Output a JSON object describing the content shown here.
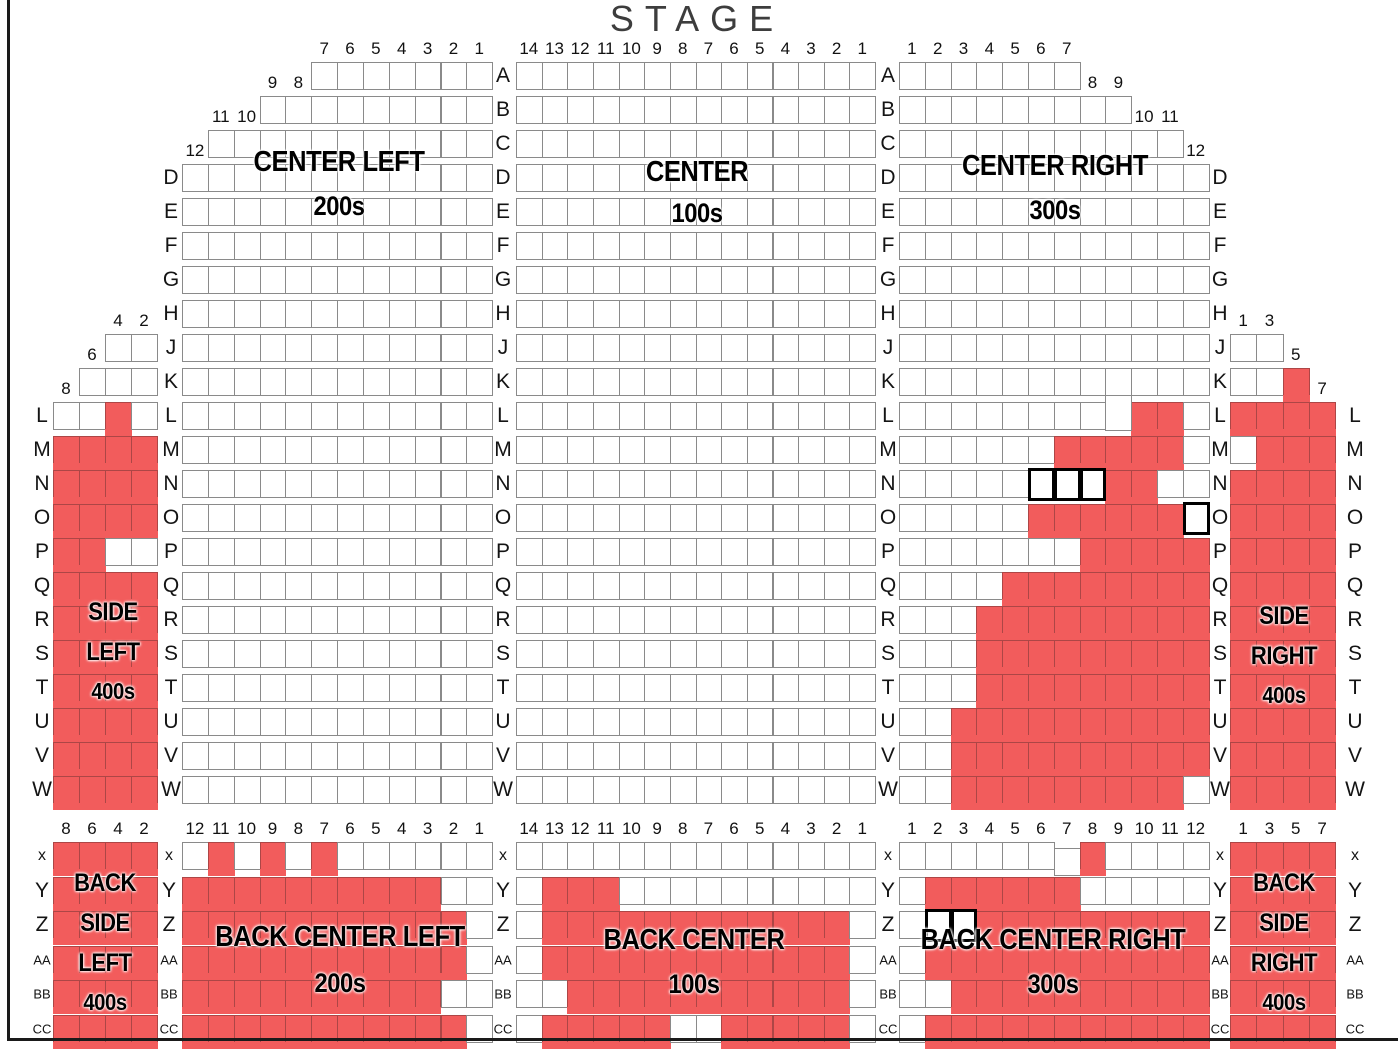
{
  "stage_label": "STAGE",
  "colors": {
    "available": "#ffffff",
    "sold": "#f25c5c",
    "seat_border": "#8a8a8a",
    "highlight_border": "#000000"
  },
  "sections": [
    {
      "id": "side_left",
      "name": "Side Left",
      "label_lines": [
        "SIDE",
        "LEFT",
        "400s"
      ],
      "headers": [
        {
          "above": "J",
          "start": 2,
          "nums": [
            "4",
            "2"
          ]
        },
        {
          "above": "K",
          "start": 1,
          "nums": [
            "6"
          ]
        },
        {
          "above": "L",
          "start": 0,
          "nums": [
            "8"
          ]
        }
      ],
      "rows": [
        {
          "r": "J",
          "off": 2,
          "s": "oo"
        },
        {
          "r": "K",
          "off": 1,
          "s": "ooo"
        },
        {
          "r": "L",
          "s": "ooxo"
        },
        {
          "r": "M",
          "s": "xxxx"
        },
        {
          "r": "N",
          "s": "xxxx"
        },
        {
          "r": "O",
          "s": "xxxx"
        },
        {
          "r": "P",
          "s": "xxoo"
        },
        {
          "r": "Q",
          "s": "xxxx"
        },
        {
          "r": "R",
          "s": "xxxx"
        },
        {
          "r": "S",
          "s": "xxxx"
        },
        {
          "r": "T",
          "s": "xxxx"
        },
        {
          "r": "U",
          "s": "xxxx"
        },
        {
          "r": "V",
          "s": "xxxx"
        },
        {
          "r": "W",
          "s": "xxxx"
        }
      ]
    },
    {
      "id": "center_left",
      "name": "Center Left",
      "label_lines": [
        "CENTER LEFT",
        "200s"
      ],
      "headers": [
        {
          "above": "A",
          "start": 5,
          "nums": [
            "7",
            "6",
            "5",
            "4",
            "3",
            "2",
            "1"
          ]
        },
        {
          "above": "B",
          "start": 3,
          "nums": [
            "9",
            "8"
          ]
        },
        {
          "above": "C",
          "start": 1,
          "nums": [
            "11",
            "10"
          ]
        },
        {
          "above": "D",
          "start": 0,
          "nums": [
            "12"
          ]
        }
      ],
      "rows": [
        {
          "r": "A",
          "off": 5,
          "s": "ooooooo"
        },
        {
          "r": "B",
          "off": 3,
          "s": "ooooooooo"
        },
        {
          "r": "C",
          "off": 1,
          "s": "ooooooooooo"
        },
        {
          "r": "D",
          "s": "oooooooooooo"
        },
        {
          "r": "E",
          "s": "oooooooooooo"
        },
        {
          "r": "F",
          "s": "oooooooooooo"
        },
        {
          "r": "G",
          "s": "oooooooooooo"
        },
        {
          "r": "H",
          "s": "oooooooooooo"
        },
        {
          "r": "J",
          "s": "oooooooooooo"
        },
        {
          "r": "K",
          "s": "oooooooooooo"
        },
        {
          "r": "L",
          "s": "oooooooooooo"
        },
        {
          "r": "M",
          "s": "oooooooooooo"
        },
        {
          "r": "N",
          "s": "oooooooooooo"
        },
        {
          "r": "O",
          "s": "oooooooooooo"
        },
        {
          "r": "P",
          "s": "oooooooooooo"
        },
        {
          "r": "Q",
          "s": "oooooooooooo"
        },
        {
          "r": "R",
          "s": "oooooooooooo"
        },
        {
          "r": "S",
          "s": "oooooooooooo"
        },
        {
          "r": "T",
          "s": "oooooooooooo"
        },
        {
          "r": "U",
          "s": "oooooooooooo"
        },
        {
          "r": "V",
          "s": "oooooooooooo"
        },
        {
          "r": "W",
          "s": "oooooooooooo"
        }
      ]
    },
    {
      "id": "center",
      "name": "Center",
      "label_lines": [
        "CENTER",
        "100s"
      ],
      "headers": [
        {
          "above": "A",
          "start": 0,
          "nums": [
            "14",
            "13",
            "12",
            "11",
            "10",
            "9",
            "8",
            "7",
            "6",
            "5",
            "4",
            "3",
            "2",
            "1"
          ]
        }
      ],
      "rows": [
        {
          "r": "A",
          "s": "oooooooooooooo"
        },
        {
          "r": "B",
          "s": "oooooooooooooo"
        },
        {
          "r": "C",
          "s": "oooooooooooooo"
        },
        {
          "r": "D",
          "s": "oooooooooooooo"
        },
        {
          "r": "E",
          "s": "oooooooooooooo"
        },
        {
          "r": "F",
          "s": "oooooooooooooo"
        },
        {
          "r": "G",
          "s": "oooooooooooooo"
        },
        {
          "r": "H",
          "s": "oooooooooooooo"
        },
        {
          "r": "J",
          "s": "oooooooooooooo"
        },
        {
          "r": "K",
          "s": "oooooooooooooo"
        },
        {
          "r": "L",
          "s": "oooooooooooooo"
        },
        {
          "r": "M",
          "s": "oooooooooooooo"
        },
        {
          "r": "N",
          "s": "oooooooooooooo"
        },
        {
          "r": "O",
          "s": "oooooooooooooo"
        },
        {
          "r": "P",
          "s": "oooooooooooooo"
        },
        {
          "r": "Q",
          "s": "oooooooooooooo"
        },
        {
          "r": "R",
          "s": "oooooooooooooo"
        },
        {
          "r": "S",
          "s": "oooooooooooooo"
        },
        {
          "r": "T",
          "s": "oooooooooooooo"
        },
        {
          "r": "U",
          "s": "oooooooooooooo"
        },
        {
          "r": "V",
          "s": "oooooooooooooo"
        },
        {
          "r": "W",
          "s": "oooooooooooooo"
        }
      ]
    },
    {
      "id": "center_right",
      "name": "Center Right",
      "label_lines": [
        "CENTER RIGHT",
        "300s"
      ],
      "headers": [
        {
          "above": "A",
          "start": 0,
          "nums": [
            "1",
            "2",
            "3",
            "4",
            "5",
            "6",
            "7"
          ]
        },
        {
          "above": "B",
          "start": 7,
          "nums": [
            "8",
            "9"
          ]
        },
        {
          "above": "C",
          "start": 9,
          "nums": [
            "10",
            "11"
          ]
        },
        {
          "above": "D",
          "start": 11,
          "nums": [
            "12"
          ]
        }
      ],
      "rows": [
        {
          "r": "A",
          "s": "ooooooo"
        },
        {
          "r": "B",
          "s": "ooooooooo"
        },
        {
          "r": "C",
          "s": "ooooooooooo"
        },
        {
          "r": "D",
          "s": "oooooooooooo"
        },
        {
          "r": "E",
          "s": "oooooooooooo"
        },
        {
          "r": "F",
          "s": "oooooooooooo"
        },
        {
          "r": "G",
          "s": "oooooooooooo"
        },
        {
          "r": "H",
          "s": "oooooooooooo"
        },
        {
          "r": "J",
          "s": "oooooooooooo"
        },
        {
          "r": "K",
          "s": "oooooooooooo"
        },
        {
          "r": "L",
          "s": "oooooooooxxo",
          "raised": [
            8
          ]
        },
        {
          "r": "M",
          "s": "ooooooxxxxxo"
        },
        {
          "r": "N",
          "s": "ooooohhhxxoo"
        },
        {
          "r": "O",
          "s": "oooooxxxxxxh"
        },
        {
          "r": "P",
          "s": "oooooooxxxxx"
        },
        {
          "r": "Q",
          "s": "ooooxxxxxxxx"
        },
        {
          "r": "R",
          "s": "oooxxxxxxxxx"
        },
        {
          "r": "S",
          "s": "oooxxxxxxxxx"
        },
        {
          "r": "T",
          "s": "oooxxxxxxxxx"
        },
        {
          "r": "U",
          "s": "ooxxxxxxxxxx"
        },
        {
          "r": "V",
          "s": "ooxxxxxxxxxx"
        },
        {
          "r": "W",
          "s": "ooxxxxxxxxxo"
        }
      ]
    },
    {
      "id": "side_right",
      "name": "Side Right",
      "label_lines": [
        "SIDE",
        "RIGHT",
        "400s"
      ],
      "headers": [
        {
          "above": "J",
          "start": 0,
          "nums": [
            "1",
            "3"
          ]
        },
        {
          "above": "K",
          "start": 2,
          "nums": [
            "5"
          ]
        },
        {
          "above": "L",
          "start": 3,
          "nums": [
            "7"
          ]
        }
      ],
      "rows": [
        {
          "r": "J",
          "s": "oo"
        },
        {
          "r": "K",
          "s": "oox"
        },
        {
          "r": "L",
          "s": "xxxx"
        },
        {
          "r": "M",
          "s": "oxxx"
        },
        {
          "r": "N",
          "s": "xxxx"
        },
        {
          "r": "O",
          "s": "xxxx"
        },
        {
          "r": "P",
          "s": "xxxx"
        },
        {
          "r": "Q",
          "s": "xxxx"
        },
        {
          "r": "R",
          "s": "xxxx"
        },
        {
          "r": "S",
          "s": "xxxx"
        },
        {
          "r": "T",
          "s": "xxxx"
        },
        {
          "r": "U",
          "s": "xxxx"
        },
        {
          "r": "V",
          "s": "xxxx"
        },
        {
          "r": "W",
          "s": "xxxx"
        }
      ]
    },
    {
      "id": "back_side_left",
      "name": "Back Side Left",
      "label_lines": [
        "BACK",
        "SIDE",
        "LEFT",
        "400s"
      ],
      "headers": [
        {
          "above": "x",
          "start": 0,
          "nums": [
            "8",
            "6",
            "4",
            "2"
          ]
        }
      ],
      "rows": [
        {
          "r": "x",
          "s": "xxxx"
        },
        {
          "r": "Y",
          "s": "xxxx"
        },
        {
          "r": "Z",
          "s": "xxxx"
        },
        {
          "r": "AA",
          "s": "xxxx"
        },
        {
          "r": "BB",
          "s": "xxxx"
        },
        {
          "r": "CC",
          "s": "xxxx"
        }
      ]
    },
    {
      "id": "back_center_left",
      "name": "Back Center Left",
      "label_lines": [
        "BACK CENTER LEFT",
        "200s"
      ],
      "headers": [
        {
          "above": "x",
          "start": 0,
          "nums": [
            "12",
            "11",
            "10",
            "9",
            "8",
            "7",
            "6",
            "5",
            "4",
            "3",
            "2",
            "1"
          ]
        }
      ],
      "rows": [
        {
          "r": "x",
          "s": "oxoxoxoooooo"
        },
        {
          "r": "Y",
          "s": "xxxxxxxxxxoo"
        },
        {
          "r": "Z",
          "s": "xxxxxxxxxxxo"
        },
        {
          "r": "AA",
          "s": "xxxxxxxxxxxo"
        },
        {
          "r": "BB",
          "s": "xxxxxxxxxxoo"
        },
        {
          "r": "CC",
          "s": "xxxxxxxxxxxo"
        }
      ]
    },
    {
      "id": "back_center",
      "name": "Back Center",
      "label_lines": [
        "BACK CENTER",
        "100s"
      ],
      "headers": [
        {
          "above": "x",
          "start": 0,
          "nums": [
            "14",
            "13",
            "12",
            "11",
            "10",
            "9",
            "8",
            "7",
            "6",
            "5",
            "4",
            "3",
            "2",
            "1"
          ]
        }
      ],
      "rows": [
        {
          "r": "x",
          "s": "oooooooooooooo"
        },
        {
          "r": "Y",
          "s": "oxxxoooooooooo"
        },
        {
          "r": "Z",
          "s": "oxxxxxxxxxxxxo"
        },
        {
          "r": "AA",
          "s": "oxxxxxxxxxxxxo"
        },
        {
          "r": "BB",
          "s": "ooxxxxxxxxxxxo"
        },
        {
          "r": "CC",
          "s": "oxxxxxooxxxxxo"
        }
      ]
    },
    {
      "id": "back_center_right",
      "name": "Back Center Right",
      "label_lines": [
        "BACK CENTER RIGHT",
        "300s"
      ],
      "headers": [
        {
          "above": "x",
          "start": 0,
          "nums": [
            "1",
            "2",
            "3",
            "4",
            "5",
            "6",
            "7",
            "8",
            "9",
            "10",
            "11",
            "12"
          ]
        }
      ],
      "rows": [
        {
          "r": "x",
          "s": "oooooooxoooo",
          "dropped": [
            6
          ]
        },
        {
          "r": "Y",
          "s": "oxxxxxxooooo"
        },
        {
          "r": "Z",
          "s": "ohhxxxxxxxxx"
        },
        {
          "r": "AA",
          "s": "oxxxxxxxxxxx"
        },
        {
          "r": "BB",
          "s": "ooxxxxxxxxxx"
        },
        {
          "r": "CC",
          "s": "oxxxxxxxxxxx"
        }
      ]
    },
    {
      "id": "back_side_right",
      "name": "Back Side Right",
      "label_lines": [
        "BACK",
        "SIDE",
        "RIGHT",
        "400s"
      ],
      "headers": [
        {
          "above": "x",
          "start": 0,
          "nums": [
            "1",
            "3",
            "5",
            "7"
          ]
        }
      ],
      "rows": [
        {
          "r": "x",
          "s": "xxxx"
        },
        {
          "r": "Y",
          "s": "xxxx"
        },
        {
          "r": "Z",
          "s": "xxxx"
        },
        {
          "r": "AA",
          "s": "xxxx"
        },
        {
          "r": "BB",
          "s": "xxxx"
        },
        {
          "r": "CC",
          "s": "xxxx"
        }
      ]
    }
  ],
  "row_label_columns": [
    {
      "id": "far-left-top",
      "letters": [
        "L",
        "M",
        "N",
        "O",
        "P",
        "Q",
        "R",
        "S",
        "T",
        "U",
        "V",
        "W"
      ]
    },
    {
      "id": "left-top",
      "letters": [
        "D",
        "E",
        "F",
        "G",
        "H",
        "J",
        "K",
        "L",
        "M",
        "N",
        "O",
        "P",
        "Q",
        "R",
        "S",
        "T",
        "U",
        "V",
        "W"
      ]
    },
    {
      "id": "center-left-top",
      "letters": [
        "A",
        "B",
        "C",
        "D",
        "E",
        "F",
        "G",
        "H",
        "J",
        "K",
        "L",
        "M",
        "N",
        "O",
        "P",
        "Q",
        "R",
        "S",
        "T",
        "U",
        "V",
        "W"
      ]
    },
    {
      "id": "center-right-top",
      "letters": [
        "A",
        "B",
        "C",
        "D",
        "E",
        "F",
        "G",
        "H",
        "J",
        "K",
        "L",
        "M",
        "N",
        "O",
        "P",
        "Q",
        "R",
        "S",
        "T",
        "U",
        "V",
        "W"
      ]
    },
    {
      "id": "right-top",
      "letters": [
        "D",
        "E",
        "F",
        "G",
        "H",
        "J",
        "K",
        "L",
        "M",
        "N",
        "O",
        "P",
        "Q",
        "R",
        "S",
        "T",
        "U",
        "V",
        "W"
      ]
    },
    {
      "id": "far-right-top",
      "letters": [
        "L",
        "M",
        "N",
        "O",
        "P",
        "Q",
        "R",
        "S",
        "T",
        "U",
        "V",
        "W"
      ]
    },
    {
      "id": "far-left-bottom",
      "letters": [
        "x",
        "Y",
        "Z",
        "AA",
        "BB",
        "CC"
      ]
    },
    {
      "id": "left-bottom",
      "letters": [
        "x",
        "Y",
        "Z",
        "AA",
        "BB",
        "CC"
      ]
    },
    {
      "id": "center-left-bottom",
      "letters": [
        "x",
        "Y",
        "Z",
        "AA",
        "BB",
        "CC"
      ]
    },
    {
      "id": "center-right-bottom",
      "letters": [
        "x",
        "Y",
        "Z",
        "AA",
        "BB",
        "CC"
      ]
    },
    {
      "id": "right-bottom",
      "letters": [
        "x",
        "Y",
        "Z",
        "AA",
        "BB",
        "CC"
      ]
    },
    {
      "id": "far-right-bottom",
      "letters": [
        "x",
        "Y",
        "Z",
        "AA",
        "BB",
        "CC"
      ]
    }
  ]
}
